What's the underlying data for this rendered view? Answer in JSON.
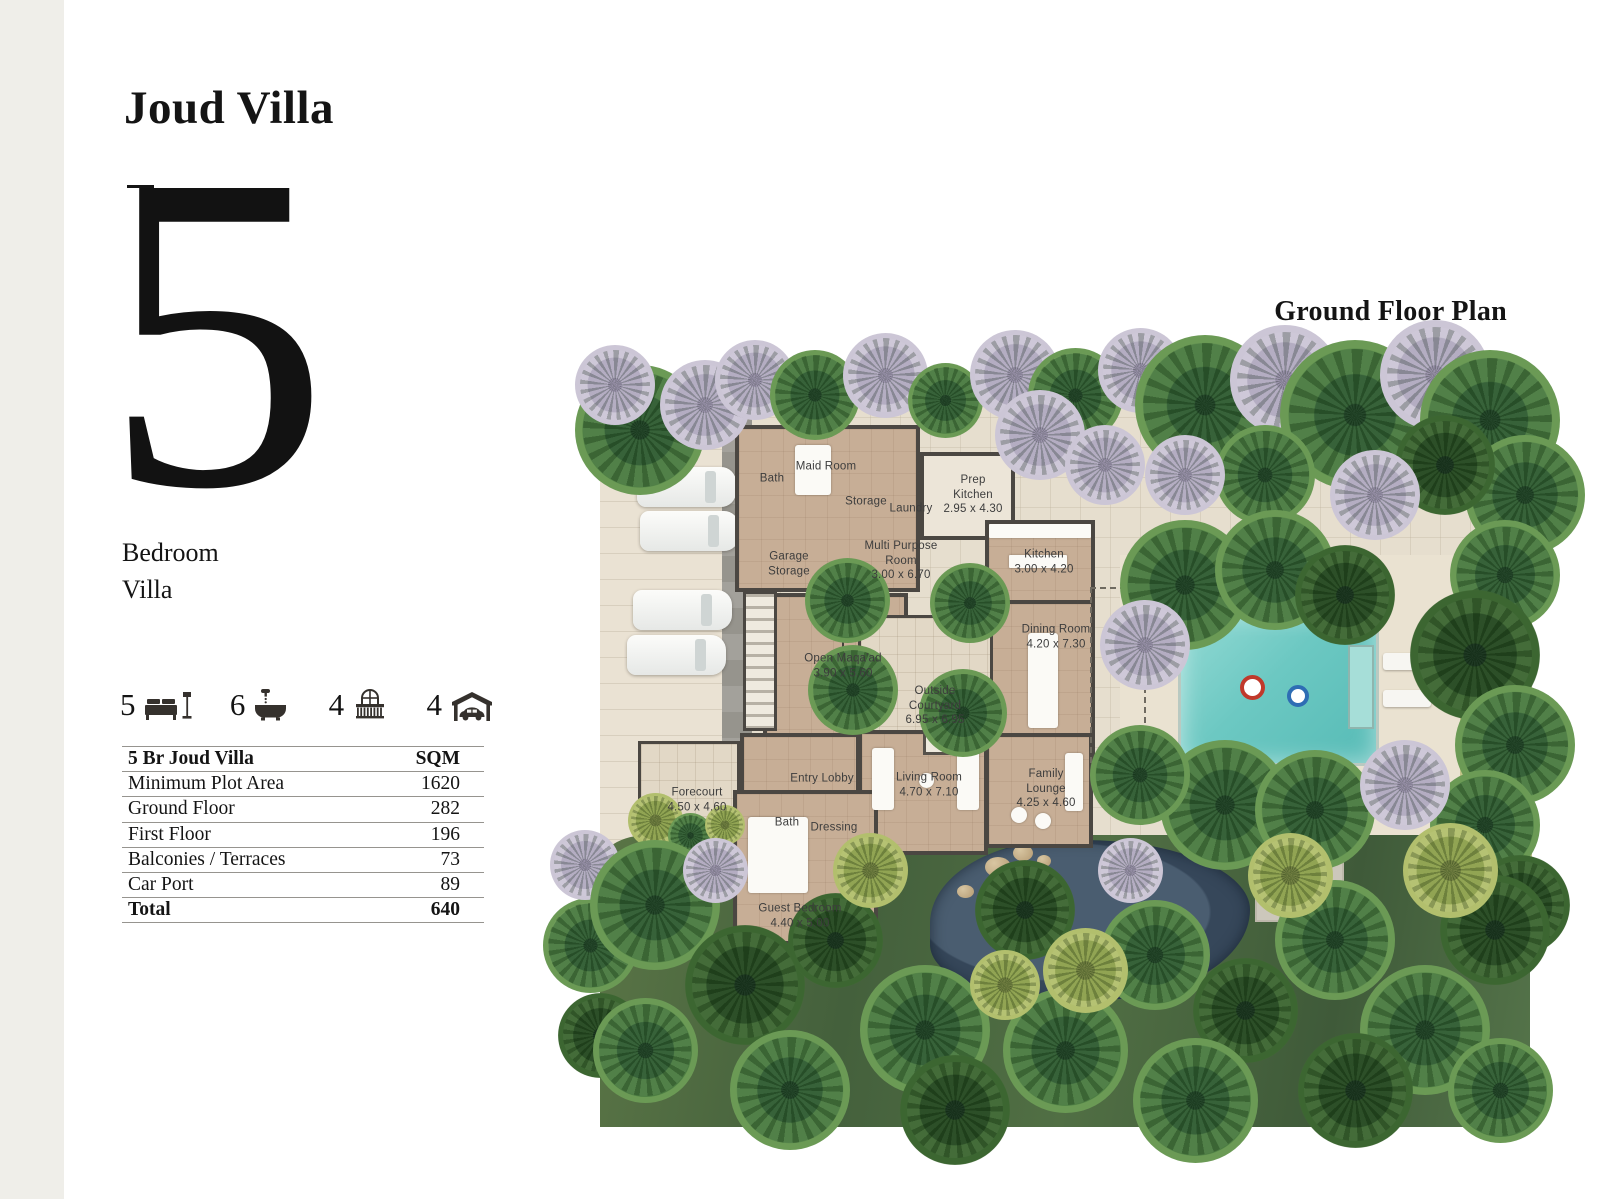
{
  "page": {
    "title": "Joud Villa",
    "unit_count": "5",
    "unit_label": "Bedroom\nVilla"
  },
  "stats": [
    {
      "value": "5",
      "icon": "bed-icon"
    },
    {
      "value": "6",
      "icon": "bath-icon"
    },
    {
      "value": "4",
      "icon": "balcony-icon"
    },
    {
      "value": "4",
      "icon": "carport-icon"
    }
  ],
  "table": {
    "header": {
      "label": "5 Br Joud Villa",
      "unit": "SQM"
    },
    "rows": [
      {
        "label": "Minimum Plot Area",
        "value": "1620"
      },
      {
        "label": "Ground Floor",
        "value": "282"
      },
      {
        "label": "First Floor",
        "value": "196"
      },
      {
        "label": "Balconies / Terraces",
        "value": "73"
      },
      {
        "label": "Car Port",
        "value": "89"
      }
    ],
    "total": {
      "label": "Total",
      "value": "640"
    }
  },
  "plan": {
    "title": "Ground Floor Plan",
    "rooms": [
      {
        "name": "Bath",
        "dims": ""
      },
      {
        "name": "Maid Room",
        "dims": ""
      },
      {
        "name": "Storage",
        "dims": ""
      },
      {
        "name": "Laundry",
        "dims": ""
      },
      {
        "name": "Prep Kitchen",
        "dims": "2.95 x 4.30"
      },
      {
        "name": "Garage Storage",
        "dims": ""
      },
      {
        "name": "Multi Purpose Room",
        "dims": "3.00 x 6.70"
      },
      {
        "name": "Kitchen",
        "dims": "3.00 x 4.20"
      },
      {
        "name": "Dining Room",
        "dims": "4.20 x 7.30"
      },
      {
        "name": "Open Maqa'ad",
        "dims": "3.90 x 5.60"
      },
      {
        "name": "Outside Courtyard",
        "dims": "6.95 x 6.95"
      },
      {
        "name": "Forecourt",
        "dims": "4.50 x 4.60"
      },
      {
        "name": "Entry Lobby",
        "dims": ""
      },
      {
        "name": "Bath",
        "dims": ""
      },
      {
        "name": "Dressing",
        "dims": ""
      },
      {
        "name": "Living Room",
        "dims": "4.70 x 7.10"
      },
      {
        "name": "Family Lounge",
        "dims": "4.25 x 4.60"
      },
      {
        "name": "Guest Bedroom",
        "dims": "4.40 x 5.00"
      }
    ]
  },
  "colors": {
    "page_background": "#ffffff",
    "left_strip": "#efeee9",
    "text": "#141414",
    "plan_walls": "#4b4742",
    "plan_floor": "#c7ae96",
    "plan_ground": "#e6dece",
    "pool_water": "#6cc8c2",
    "vegetation": "#4a7b41",
    "pond_water": "#36475a"
  }
}
